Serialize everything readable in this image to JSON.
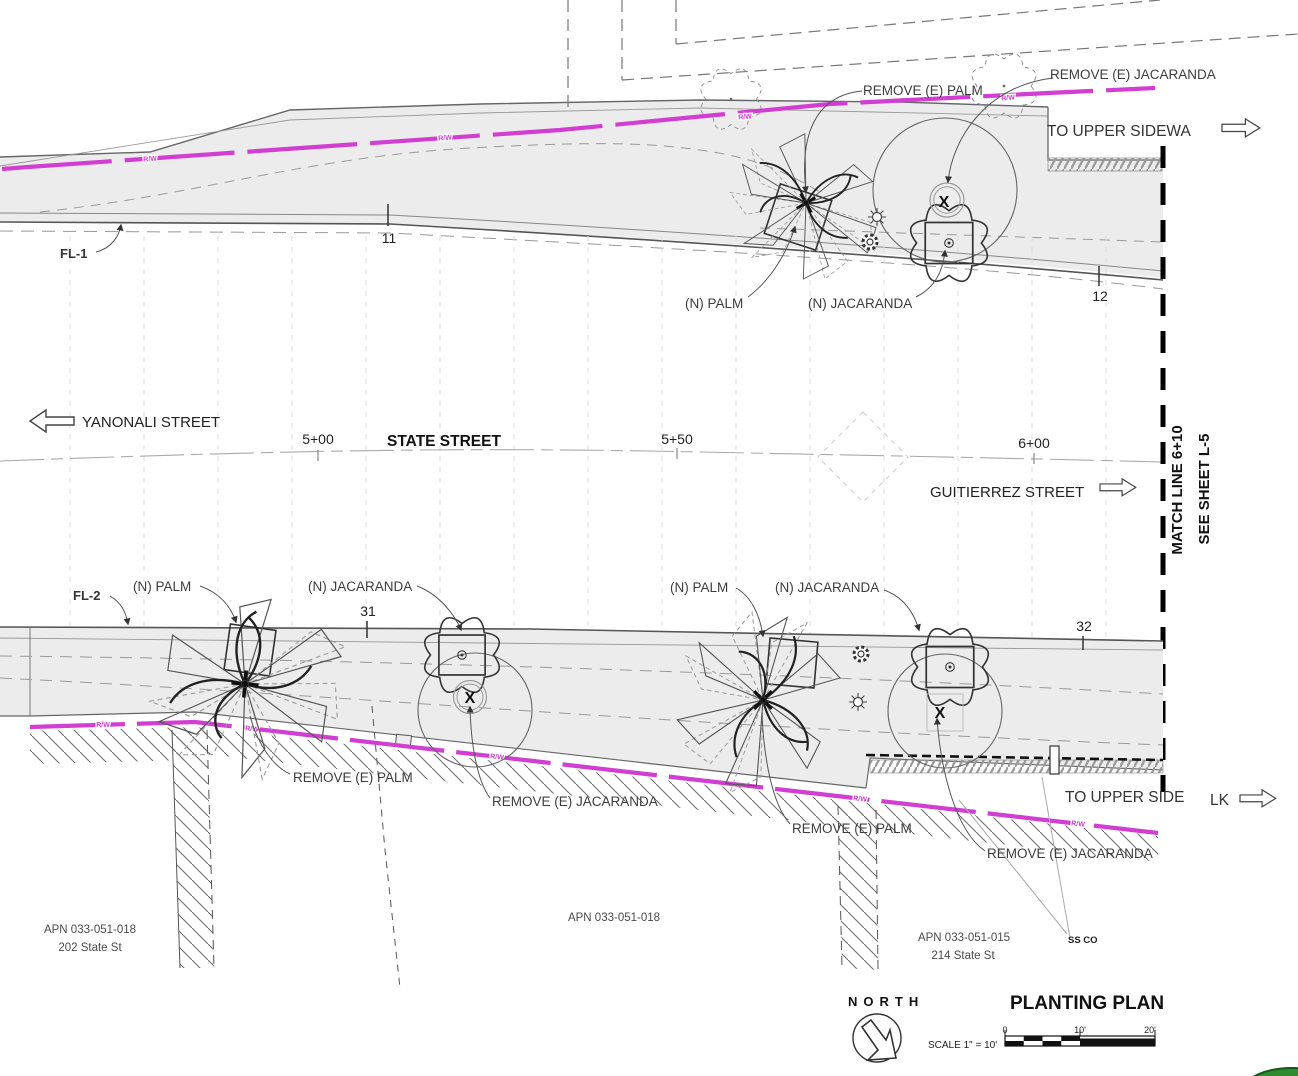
{
  "colors": {
    "right_of_way_magenta": "#d13ed1",
    "sidewalk_fill": "#ececec",
    "matchline_black": "#000000",
    "landscape_green": "#2f8b2f"
  },
  "streets": {
    "left_label": "YANONALI STREET",
    "main_label": "STATE STREET",
    "right_label": "GUITIERREZ STREET"
  },
  "stations": {
    "s500": "5+00",
    "s550": "5+50",
    "s600": "6+00",
    "tick11": "11",
    "tick12": "12",
    "tick31": "31",
    "tick32": "32"
  },
  "flowline_labels": {
    "fl1": "FL-1",
    "fl2": "FL-2"
  },
  "tree_labels": {
    "remove_palm": "REMOVE (E) PALM",
    "remove_jacaranda": "REMOVE (E) JACARANDA",
    "new_palm": "(N) PALM",
    "new_jacaranda": "(N) JACARANDA",
    "remove_marker": "X"
  },
  "matchline": {
    "label": "MATCH LINE 6+10",
    "sheet": "SEE SHEET L-5"
  },
  "notes": {
    "rw": "R/W",
    "to_upper_sidewalk": "TO UPPER SIDEWA",
    "to_upper_side": "TO UPPER SIDE",
    "lk": "LK",
    "ss_co": "SS CO"
  },
  "parcels": {
    "apn_left_1": "APN 033-051-018",
    "apn_left_2": "202 State St",
    "apn_center": "APN 033-051-018",
    "apn_right_1": "APN 033-051-015",
    "apn_right_2": "214 State St"
  },
  "titleblock": {
    "north": "NORTH",
    "title": "PLANTING PLAN",
    "scale": "SCALE 1\" = 10'",
    "tick0": "0",
    "tick10": "10'",
    "tick20": "20'"
  }
}
